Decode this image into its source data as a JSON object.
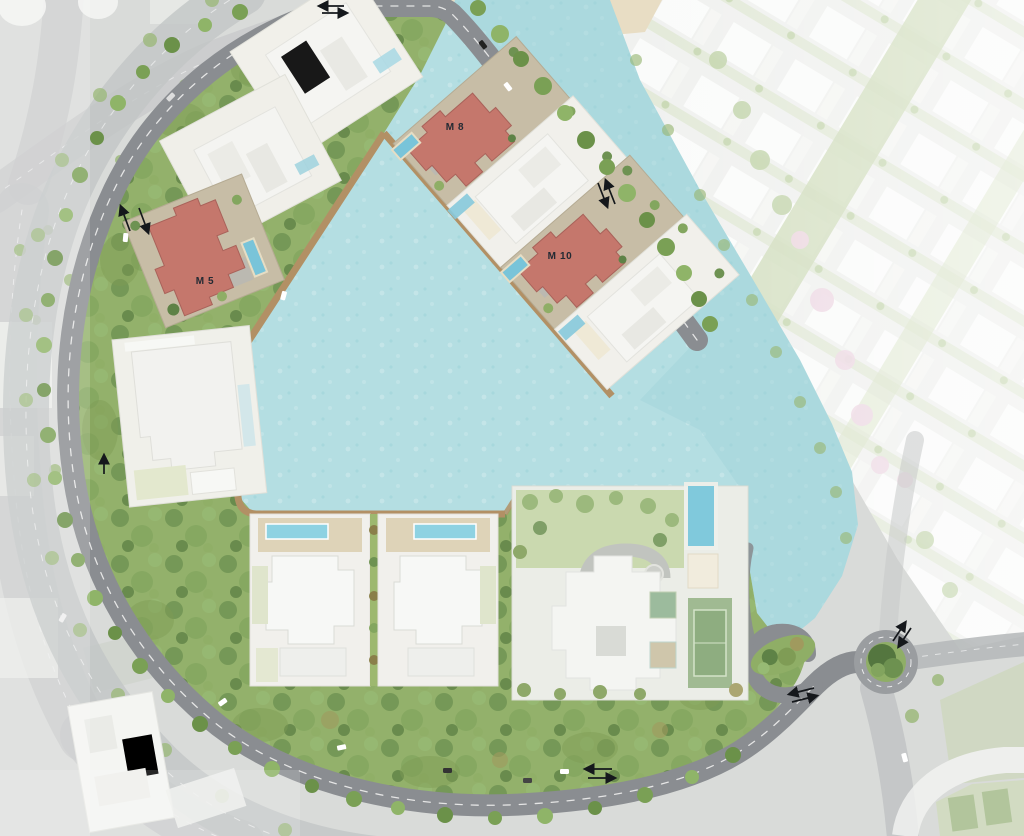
{
  "map": {
    "name": "lagoon-community-master-plan",
    "view": "aerial-site-plan",
    "villas": [
      {
        "id": "m5",
        "label": "M 5",
        "highlight_color": "#c5776c"
      },
      {
        "id": "m8",
        "label": "M 8",
        "highlight_color": "#c5776c"
      },
      {
        "id": "m10",
        "label": "M 10",
        "highlight_color": "#c5776c"
      }
    ],
    "features": {
      "lagoon": "central-lagoon",
      "channel": "water-channel",
      "beach": "sand-beach",
      "boardwalk": "lagoon-boardwalk",
      "green_belt": "perimeter-green-belt",
      "ring_road": "ring-road",
      "roundabout": "roundabout",
      "clubhouse": "clubhouse-amenity-plot",
      "clubhouse_pool": "swimming-pool",
      "tennis_court": "tennis-court",
      "neighborhood": "neighboring-villa-district"
    },
    "colors": {
      "water": "#b4dee2",
      "water_deep": "#9fd3d9",
      "sand": "#e8ddc4",
      "boardwalk": "#b29065",
      "green_belt": "#93b16b",
      "road": "#8a8d91",
      "road_faded": "#c5c7c8",
      "villa_highlight": "#c5776c",
      "plot_tan": "#c7bda6",
      "plot_white": "#f1f0eb",
      "pool_blue": "#79c4d9",
      "tennis_green": "#84a671",
      "label_text": "#232a33"
    }
  }
}
